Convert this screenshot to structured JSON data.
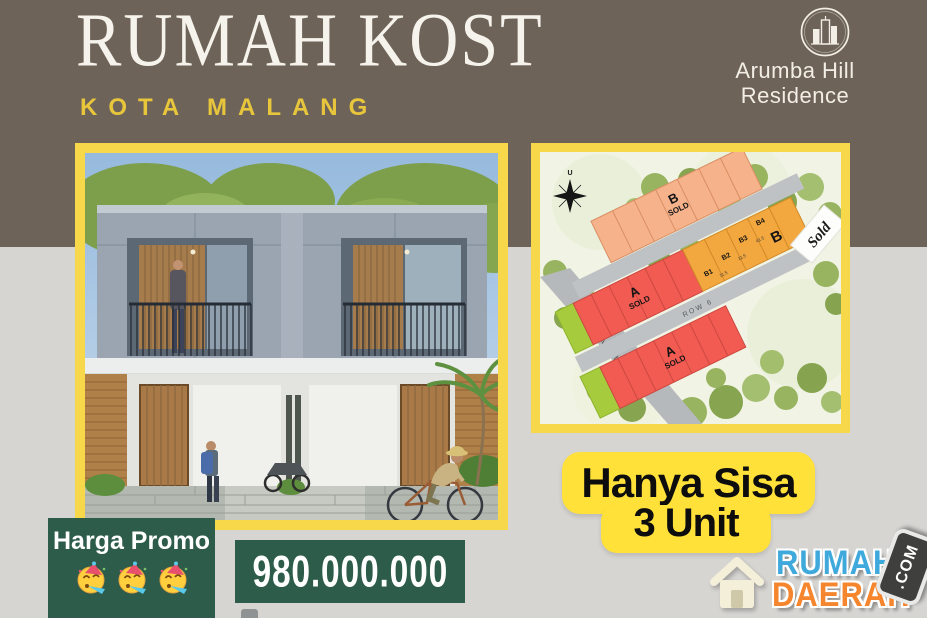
{
  "colors": {
    "brown": "#6e6359",
    "gray": "#d6d5d2",
    "frame_yellow": "#f7d84b",
    "badge_yellow": "#ffe13a",
    "green": "#2d5c4b",
    "wm_blue": "#3fa9dc",
    "wm_orange": "#f5862e",
    "lot_red": "#f15b52",
    "lot_peach": "#f6b28b",
    "lot_orange": "#f3a83f",
    "lot_green": "#a6cb3d"
  },
  "header": {
    "title": "RUMAH KOST",
    "subtitle": "KOTA MALANG"
  },
  "brand": {
    "name_line1": "Arumba Hill",
    "name_line2": "Residence"
  },
  "site_plan": {
    "compass_label": "U",
    "road_main": "Jl. Arumba",
    "road_row": "ROW 6",
    "sold_sign": "Sold",
    "block_a": "A",
    "block_b": "B",
    "sold": "SOLD",
    "b_lots": [
      "B1",
      "B2",
      "B3",
      "B4"
    ],
    "dims": [
      "11.5",
      "11.5",
      "41.5"
    ]
  },
  "promo": {
    "remaining_line1": "Hanya Sisa",
    "remaining_line2": "3 Unit",
    "harga_label": "Harga Promo",
    "price": "980.000.000"
  },
  "watermark": {
    "word_top": "RUMAH",
    "word_bottom": "DAERAH",
    "badge": ".COM"
  }
}
